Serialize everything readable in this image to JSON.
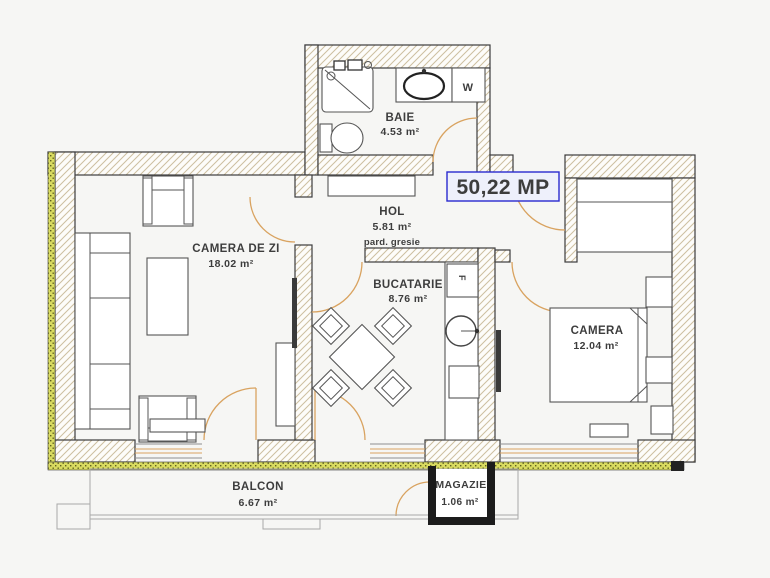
{
  "plan": {
    "total_area_label": "50,22 MP",
    "rooms": {
      "baie": {
        "name": "BAIE",
        "area": "4.53 m²"
      },
      "hol": {
        "name": "HOL",
        "area": "5.81 m²",
        "floor_note": "pard. gresie"
      },
      "camera_de_zi": {
        "name": "CAMERA DE ZI",
        "area": "18.02 m²"
      },
      "bucatarie": {
        "name": "BUCATARIE",
        "area": "8.76 m²"
      },
      "camera": {
        "name": "CAMERA",
        "area": "12.04 m²"
      },
      "balcon": {
        "name": "BALCON",
        "area": "6.67 m²"
      },
      "magazie": {
        "name": "MAGAZIE",
        "area": "1.06 m²"
      }
    },
    "fixtures": {
      "washing_machine": "W",
      "fridge": "F"
    },
    "colors": {
      "accent_blue": "#1518c8",
      "door_orange": "#d9a360",
      "insulation_yellow": "#d9db60",
      "hatch_tan": "#cdbfa0",
      "line_dark": "#3c3c3c",
      "background": "#f6f6f4"
    }
  }
}
